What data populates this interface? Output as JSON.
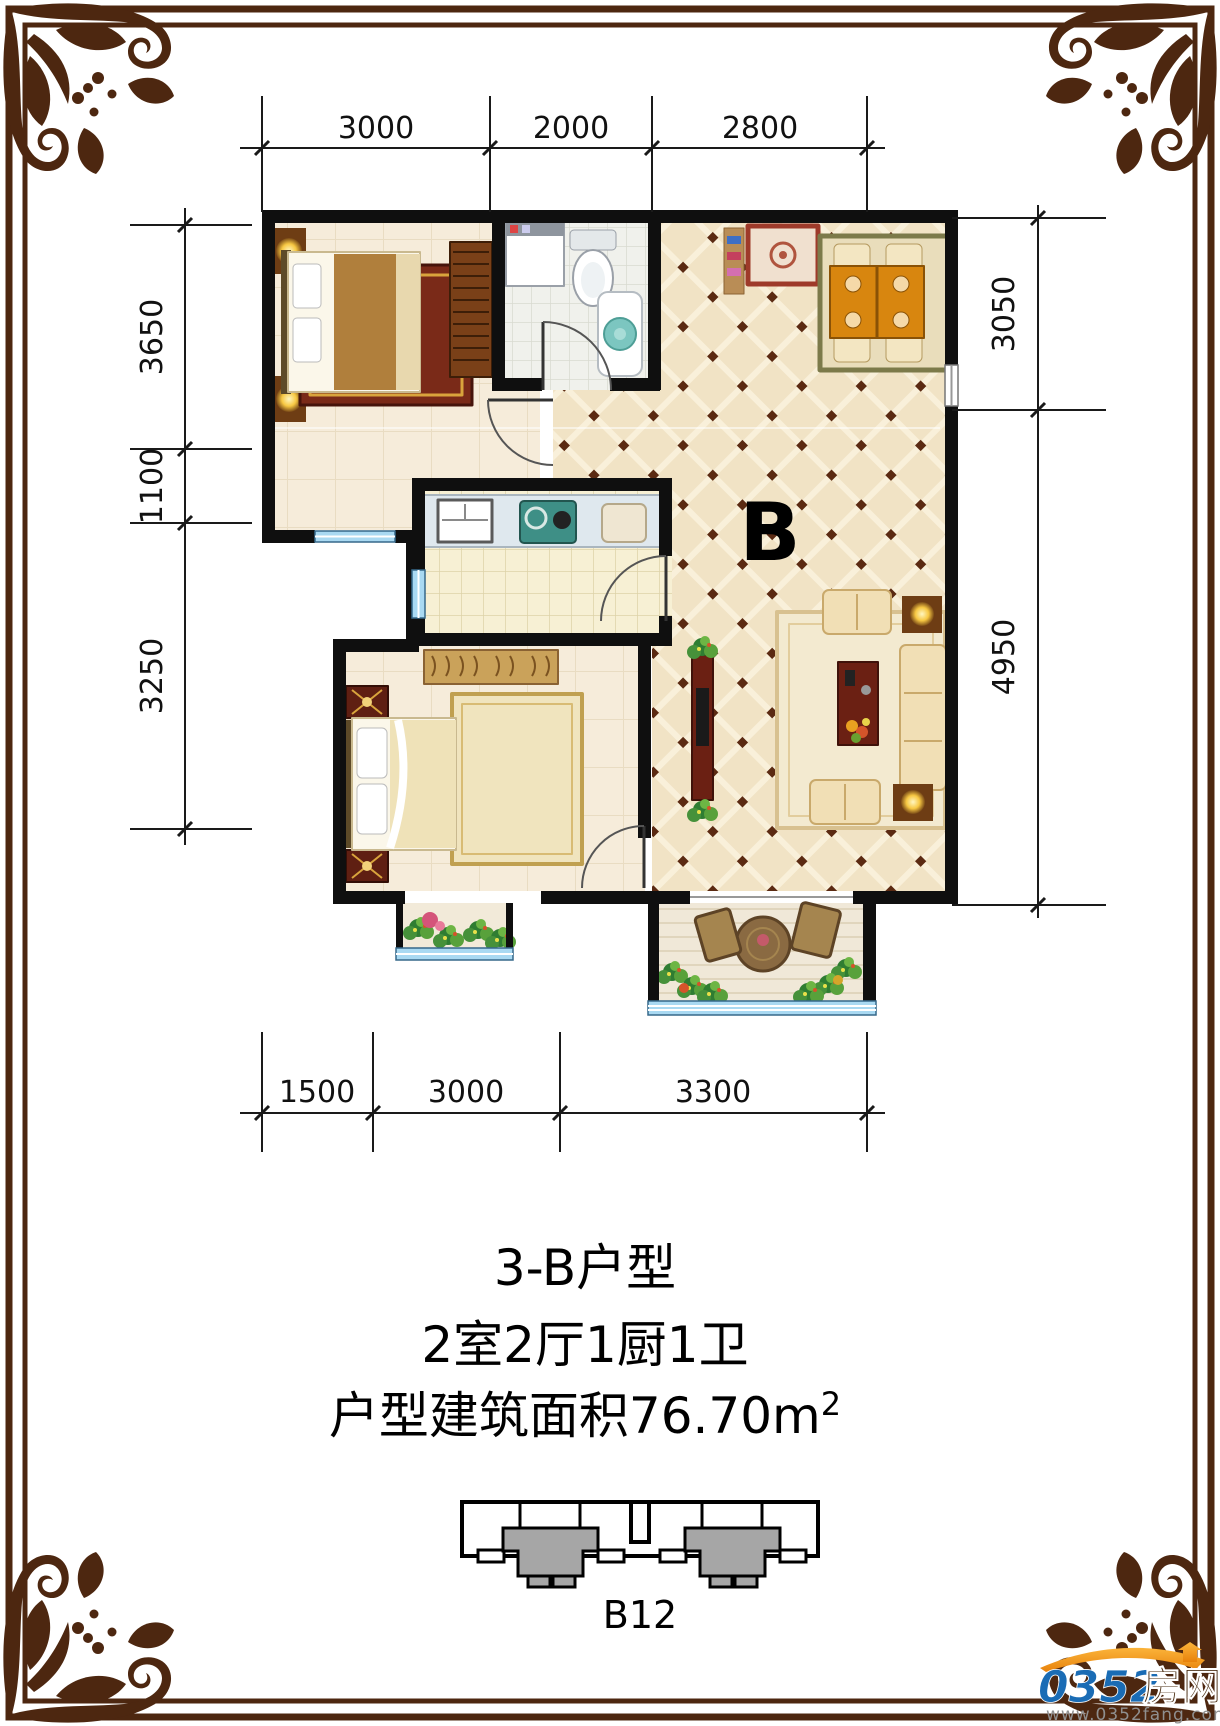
{
  "plan": {
    "unit_label": "B"
  },
  "dimensions": {
    "top": [
      "3000",
      "2000",
      "2800"
    ],
    "bottom": [
      "1500",
      "3000",
      "3300"
    ],
    "left": [
      "3650",
      "1100",
      "3250"
    ],
    "right": [
      "3050",
      "4950"
    ]
  },
  "titles": {
    "line1": "3-B户型",
    "line2": "2室2厅1厨1卫",
    "area_main": "户型建筑面积76.70m",
    "area_sup": "2"
  },
  "key_plan": {
    "label": "B12"
  },
  "logo": {
    "number": "0352",
    "cn": "房网",
    "url": "www.0352fang.com"
  },
  "colors": {
    "border": "#4d2710",
    "wall": "#0f0f0f",
    "window": "#a9d9f2",
    "key_highlight": "#a6a6a6",
    "logo_blue": "#1a6cb5",
    "logo_orange": "#f59d1e",
    "logo_url_gray": "#8f8f8f"
  }
}
